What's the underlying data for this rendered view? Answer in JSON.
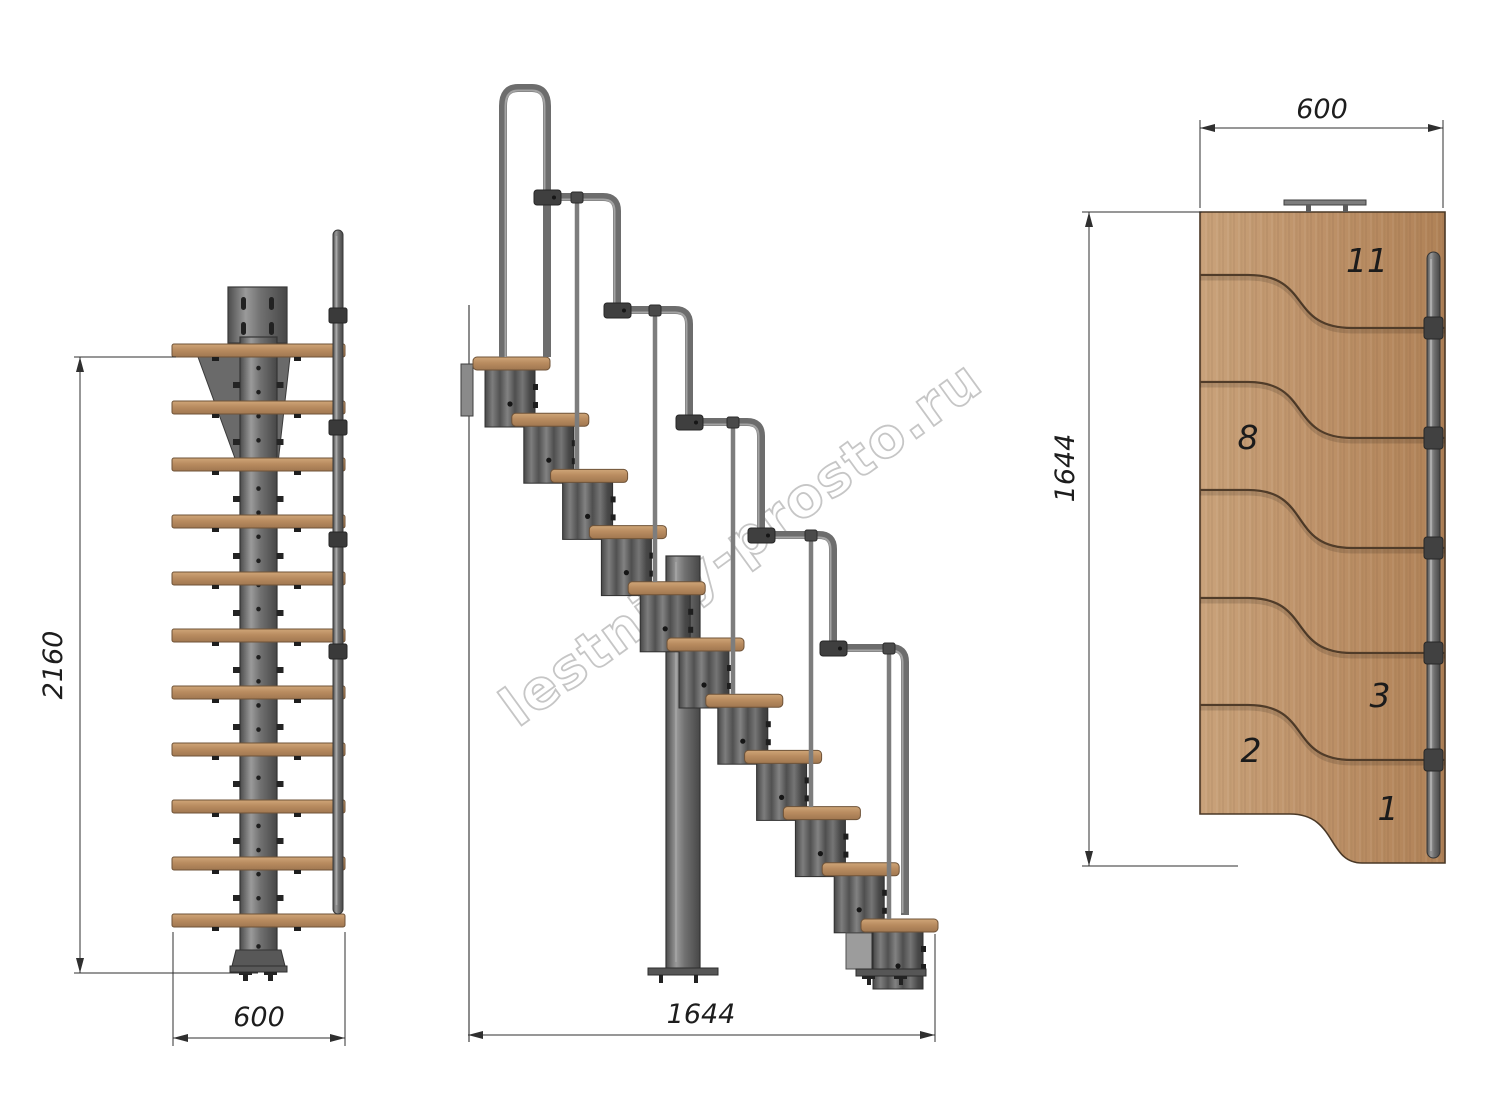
{
  "watermark": {
    "text": "lestnicy-prosto.ru"
  },
  "views": {
    "front": {
      "height_label": "2160",
      "width_label": "600"
    },
    "side": {
      "length_label": "1644"
    },
    "plan": {
      "width_label": "600",
      "length_label": "1644",
      "step_numbers": [
        "11",
        "8",
        "3",
        "2",
        "1"
      ]
    }
  },
  "colors": {
    "wood": "#b98c60",
    "wood_light": "#c9a27a",
    "steel": "#6e6e6e",
    "steel_dark": "#3f3f3f",
    "dimension_lines": "#2f2f2f",
    "watermark_grey": "#c6c6c6",
    "background": "#ffffff"
  }
}
